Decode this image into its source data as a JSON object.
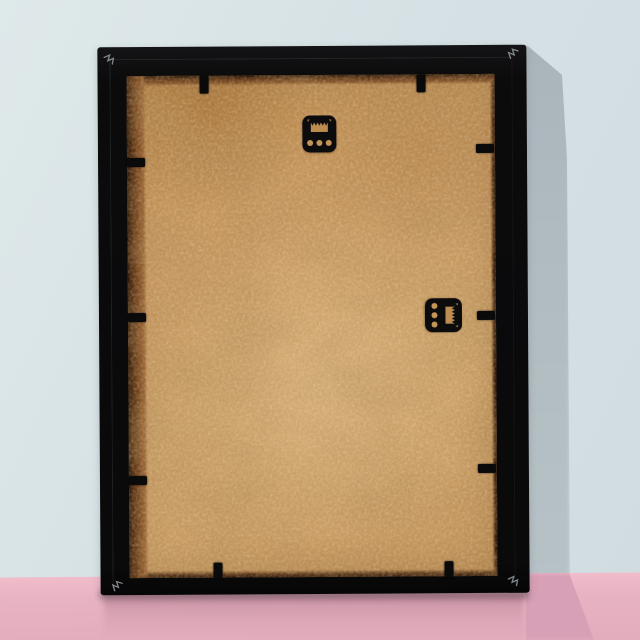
{
  "image_description": "Back view of a black picture frame leaning against a pale blue wall on a pink surface, showing a plain MDF hardboard backing board held by black flexi tabs, two black sawtooth hangers and metal v-nail staples in each corner",
  "scene": {
    "colors": {
      "wall": "#d5e1e4",
      "wall-shadow": "#b0bbc1",
      "floor": "#e7b2c2",
      "floor-shadow": "#d8a0b6",
      "frame": "#0b0b0c",
      "mdf": "#ca9b63",
      "mdf-edge": "#7c4a22",
      "hardware": "#0c0c0d",
      "staple": "#979da2"
    }
  },
  "frame": {
    "view": "rear",
    "material_finish": "matte black",
    "backing": "MDF hardboard, bare tan finish",
    "hangers": [
      {
        "id": "sawtooth-hanger-top",
        "style": "sawtooth plate",
        "orientation": "horizontal",
        "holes": 3,
        "position": "top center"
      },
      {
        "id": "sawtooth-hanger-side",
        "style": "sawtooth plate",
        "orientation": "vertical",
        "holes": 3,
        "position": "middle right"
      }
    ],
    "corner_staples": 4,
    "flexi_tabs": {
      "top": {
        "axis": "x",
        "w": 9,
        "h": 18,
        "edge": 29,
        "offsets": [
          102,
          319
        ]
      },
      "bottom": {
        "axis": "x",
        "w": 9,
        "h": 16,
        "edge": 516,
        "offsets": [
          113,
          344
        ]
      },
      "left": {
        "axis": "y",
        "w": 18,
        "h": 9,
        "edge": 29,
        "offsets": [
          111,
          266,
          429
        ]
      },
      "right": {
        "axis": "y",
        "w": 18,
        "h": 9,
        "edge": 378,
        "offsets": [
          99,
          266,
          419
        ]
      }
    }
  }
}
